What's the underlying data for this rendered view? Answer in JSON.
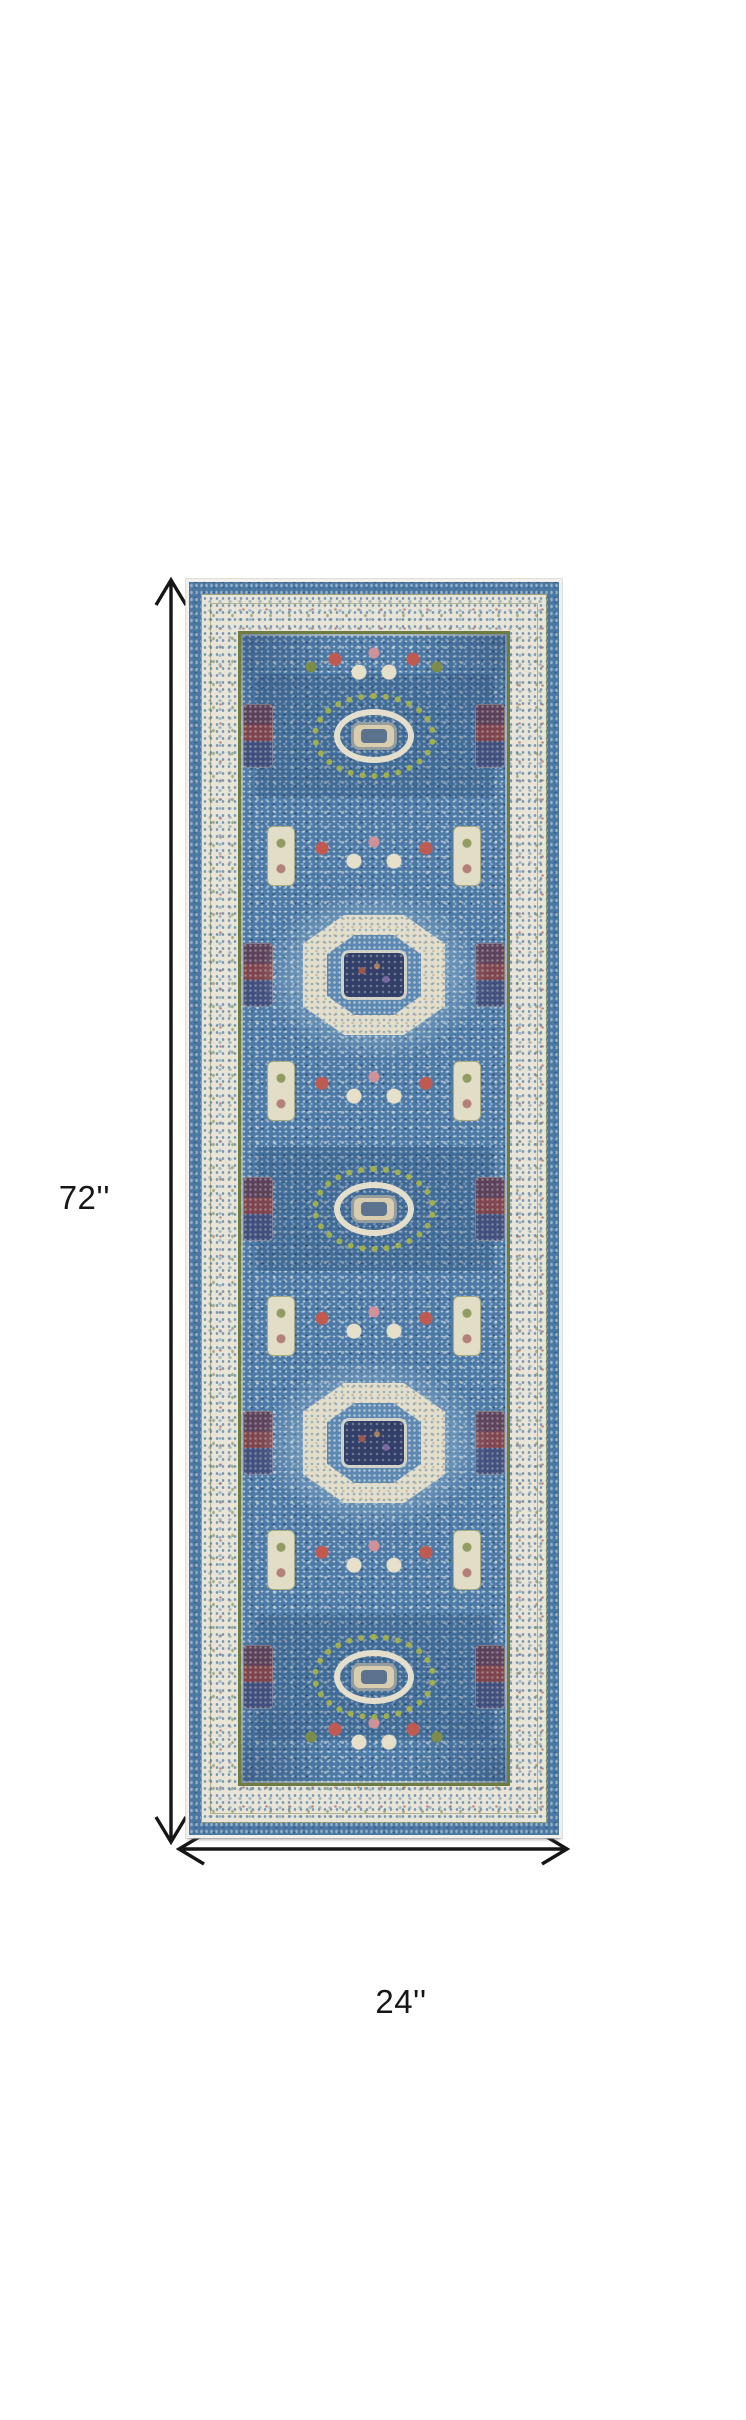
{
  "page": {
    "background": "#ffffff",
    "description": "Product dimension diagram of a 2' x 6' blue and ivory Mamluk-style runner rug shown flat, with a vertical arrow annotating its length and a horizontal arrow annotating its width"
  },
  "dimension_annotation": {
    "height_label": "72''",
    "width_label": "24''",
    "arrow_color": "#161616"
  },
  "product_image": {
    "name": "blue-mamluk-runner-rug",
    "description": "Vertical runner rug with denim blue outer band, speckled ivory ornate border, olive guard stripes, and a blue field holding five alternating medallions flanked by maroon ornaments, cream panels and red, pink and olive flower clusters",
    "orientation": "vertical",
    "medallions": [
      {
        "type": "oval",
        "ring": "green dotted"
      },
      {
        "type": "octagon",
        "ring": "cream"
      },
      {
        "type": "oval",
        "ring": "green dotted"
      },
      {
        "type": "octagon",
        "ring": "cream"
      },
      {
        "type": "oval",
        "ring": "green dotted"
      }
    ],
    "palette": {
      "band_blue": "#4b77a3",
      "border_cream": "#e8e5d8",
      "guard_olive": "#6d7c41",
      "field_blue": "#4d7aa6",
      "ring_green": "#9fae4e",
      "medallion_cream": "#e3dfcc",
      "center_navy": "#323f68",
      "accent_red": "#c05a50",
      "accent_pink": "#d09198",
      "accent_olive": "#7d8c49"
    }
  }
}
